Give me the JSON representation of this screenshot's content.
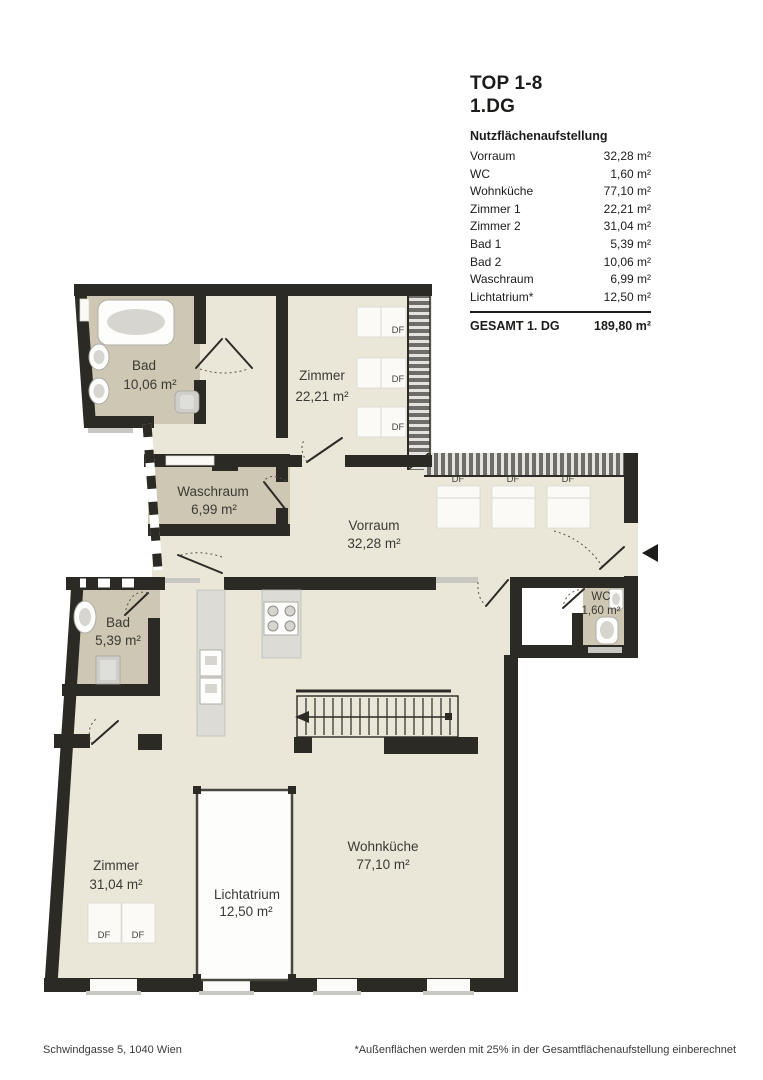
{
  "header": {
    "title_line1": "TOP 1-8",
    "title_line2": "1.DG"
  },
  "table": {
    "header": "Nutzflächenaufstellung",
    "rows": [
      {
        "label": "Vorraum",
        "value": "32,28 m²"
      },
      {
        "label": "WC",
        "value": "1,60 m²"
      },
      {
        "label": "Wohnküche",
        "value": "77,10 m²"
      },
      {
        "label": "Zimmer 1",
        "value": "22,21 m²"
      },
      {
        "label": "Zimmer 2",
        "value": "31,04 m²"
      },
      {
        "label": "Bad 1",
        "value": "5,39 m²"
      },
      {
        "label": "Bad 2",
        "value": "10,06 m²"
      },
      {
        "label": "Waschraum",
        "value": "6,99 m²"
      },
      {
        "label": "Lichtatrium*",
        "value": "12,50 m²"
      }
    ],
    "total": {
      "label": "GESAMT 1. DG",
      "value": "189,80 m²"
    }
  },
  "plan": {
    "df_label": "DF",
    "rooms": [
      {
        "name": "Bad",
        "area": "10,06 m²"
      },
      {
        "name": "Zimmer",
        "area": "22,21 m²"
      },
      {
        "name": "Waschraum",
        "area": "6,99 m²"
      },
      {
        "name": "Vorraum",
        "area": "32,28 m²"
      },
      {
        "name": "WC",
        "area": "1,60 m²"
      },
      {
        "name": "Bad",
        "area": "5,39 m²"
      },
      {
        "name": "Zimmer",
        "area": "31,04 m²"
      },
      {
        "name": "Lichtatrium",
        "area": "12,50 m²"
      },
      {
        "name": "Wohnküche",
        "area": "77,10 m²"
      }
    ],
    "colors": {
      "wall": "#2b2a24",
      "floor_light": "#eae7d9",
      "floor_wet": "#cdc7b3",
      "hatch_dark": "#6e6d68",
      "page_bg": "#ffffff"
    }
  },
  "footer": {
    "address": "Schwindgasse 5, 1040 Wien",
    "note": "*Außenflächen werden mit 25% in der Gesamtflächenaufstellung einberechnet"
  }
}
